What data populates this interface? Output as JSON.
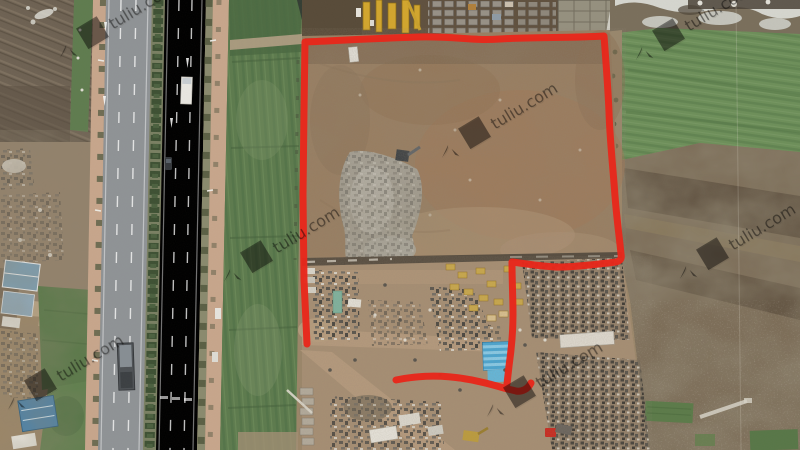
{
  "image": {
    "type": "aerial-drone-photo",
    "subject": "rural land parcel outlined in red beside a tree-lined divided highway, with construction machinery, a junkyard, farmland strips and scrubland",
    "watermark": {
      "cn": "土流网",
      "en": "tuliu.com",
      "color": "#ffffff",
      "opacity": 0.42,
      "instances": [
        {
          "transform": "translate(4,66) rotate(-31)"
        },
        {
          "transform": "translate(386,166) rotate(-31)"
        },
        {
          "transform": "translate(580,68) rotate(-31)"
        },
        {
          "transform": "translate(168,290) rotate(-31)"
        },
        {
          "transform": "translate(624,287) rotate(-31)"
        },
        {
          "transform": "translate(431,425) rotate(-31)"
        },
        {
          "transform": "translate(-48,418) rotate(-31)"
        }
      ]
    },
    "boundary": {
      "color": "#e8281b",
      "stroke_width": 7,
      "main_path": "M307,344 L304,280 303,195 304,110 305,42 C330,41 360,39 418,37 C455,36 470,41 500,39 C530,37 575,38 604,36 C606,62 608,88 609,112 C610,142 613,168 615,196 C617,222 620,242 621,254 C622,259 620,261 616,262 C598,264 578,267 560,267 C544,267 528,264 512,262 C512,280 513,298 513,315 C513,335 511,352 509,366 L507,384",
      "bottom_path": "M396,380 C420,375 444,375 466,379 C486,382 502,388 516,391 C522,392 528,389 531,383"
    },
    "palette": {
      "road_asphalt": "#8f9396",
      "sidewalk_pink": "#c7a68c",
      "median_trees": "#3e5134",
      "green_field_right": "#6e9059",
      "canal_strip_green": "#5d7b4e",
      "parcel_dirt": "#997e61",
      "parcel_red_dirt": "#a17757",
      "rubble_gray": "#a5a297",
      "junkyard_ground": "#a68e73",
      "scrap_dark": "#53504a",
      "scrubland": "#7d6e59",
      "plowed_field": "#6e6253",
      "pond_water": "#343e34",
      "machinery_yellow": "#d2a62e",
      "shed_blue": "#49a6d2",
      "truck_red": "#c92a20",
      "snow_white": "#dfe1dc"
    }
  }
}
